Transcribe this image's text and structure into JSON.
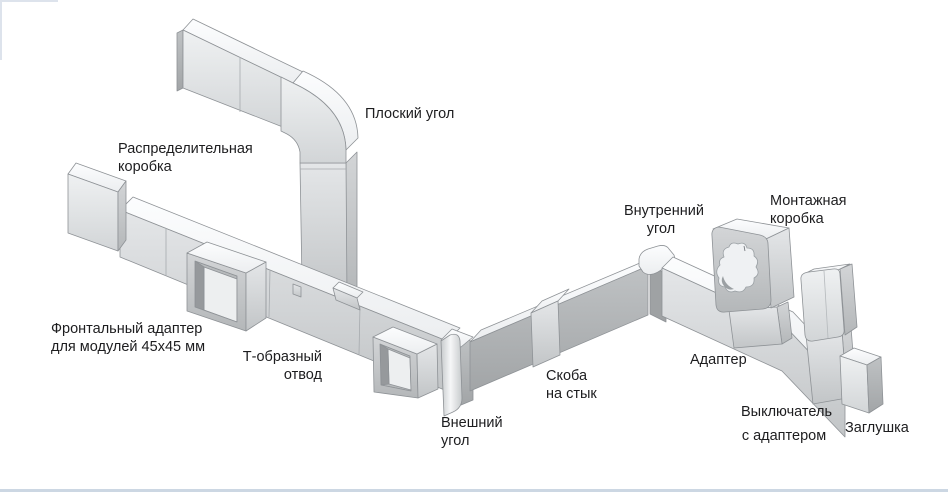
{
  "diagram": {
    "subject": "cable trunking system components",
    "labels": {
      "distribution_box": {
        "text": "Распределительная\nкоробка"
      },
      "flat_angle": {
        "text": "Плоский угол"
      },
      "front_adapter": {
        "text": "Фронтальный адаптер\nдля модулей 45х45 мм"
      },
      "t_branch": {
        "text": "Т-образный\nотвод"
      },
      "outer_corner": {
        "text": "Внешний\nугол"
      },
      "joint_clip": {
        "text": "Скоба\nна стык"
      },
      "inner_corner": {
        "text": "Внутренний\nугол"
      },
      "mounting_box": {
        "text": "Монтажная\nкоробка"
      },
      "adapter": {
        "text": "Адаптер"
      },
      "switch": {
        "text": "Выключатель\nс адаптером"
      },
      "end_cap": {
        "text": "Заглушка"
      }
    },
    "palette": {
      "ink": "#1d1d1f",
      "plastic_light": "#f7f8fa",
      "plastic_mid": "#c9ccce",
      "plastic_dark": "#a6a9ab",
      "bottom_rule": "#ccd7e3"
    }
  }
}
